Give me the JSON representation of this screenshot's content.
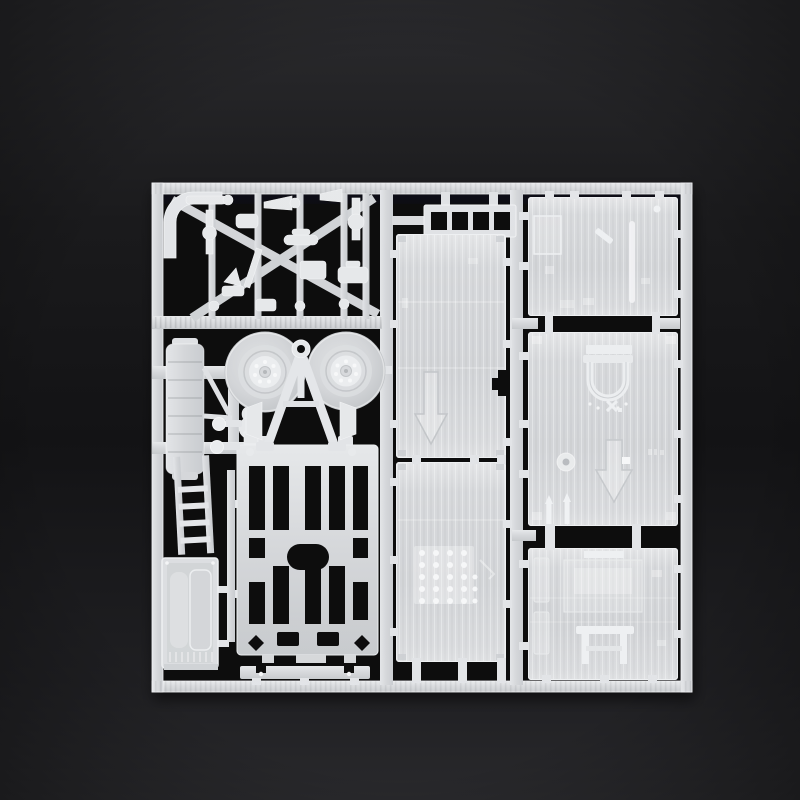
{
  "scene": {
    "description": "Photograph of a white injection-molded polystyrene model kit sprue (parts tree) lying on a dark surface",
    "material": "translucent white styrene plastic",
    "background": "black studio surface with soft gradient lighting"
  },
  "colors": {
    "background_top": "#2b2b2e",
    "background_mid": "#141416",
    "background_bottom": "#29292c",
    "hole_black": "#0a0a0b",
    "plastic": "#d6d8db",
    "plastic_light": "#e8eaec",
    "plastic_bright": "#f3f4f6",
    "plastic_shadow": "#b7babe",
    "panel_base": "#d3d5d8",
    "panel_stripe": "#c7cacd"
  },
  "parts": {
    "frame": {
      "label": "rectangular sprue frame"
    },
    "runners": {
      "label": "internal runner bars"
    },
    "cluster": {
      "label": "cluster of small suspension and fitting parts"
    },
    "window_strip": {
      "label": "strip part with four window openings"
    },
    "panel_roof": {
      "label": "large roof panel with embossed arrow"
    },
    "panel_floor": {
      "label": "large floor panel with rivet grid"
    },
    "panel_side_top": {
      "label": "square side panel with window detail"
    },
    "panel_side_hatch": {
      "label": "square side panel with hatch and arrow"
    },
    "panel_side_bench": {
      "label": "square side panel with bench detail"
    },
    "wheel_left": {
      "label": "spoked road wheel"
    },
    "wheel_right": {
      "label": "spoked road wheel"
    },
    "tow_ring": {
      "label": "tow ring eyelet"
    },
    "a_frame": {
      "label": "A-frame drawbar"
    },
    "chassis": {
      "label": "ladder chassis frame"
    },
    "tank": {
      "label": "ribbed tank / step part"
    },
    "ladder": {
      "label": "access ladder"
    },
    "door": {
      "label": "door panel"
    },
    "pins": {
      "label": "round-headed pins"
    },
    "buffer_strip": {
      "label": "notched buffer strip"
    },
    "gates": {
      "label": "sprue gate stubs"
    }
  }
}
